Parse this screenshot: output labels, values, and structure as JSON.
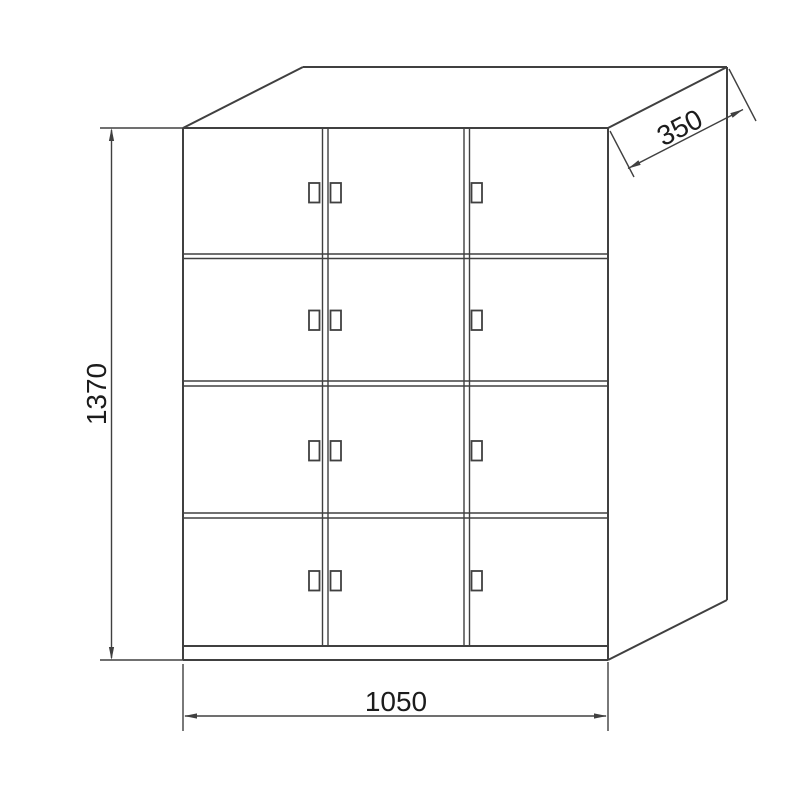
{
  "drawing": {
    "dimensions": {
      "height": "1370",
      "width": "1050",
      "depth": "350"
    },
    "structure": {
      "door_rows": 4,
      "door_columns": 3,
      "compartments": 12,
      "handles_per_row": 3
    },
    "colors": {
      "line": "#404040",
      "text": "#1c1c1c",
      "background": "#ffffff"
    }
  }
}
